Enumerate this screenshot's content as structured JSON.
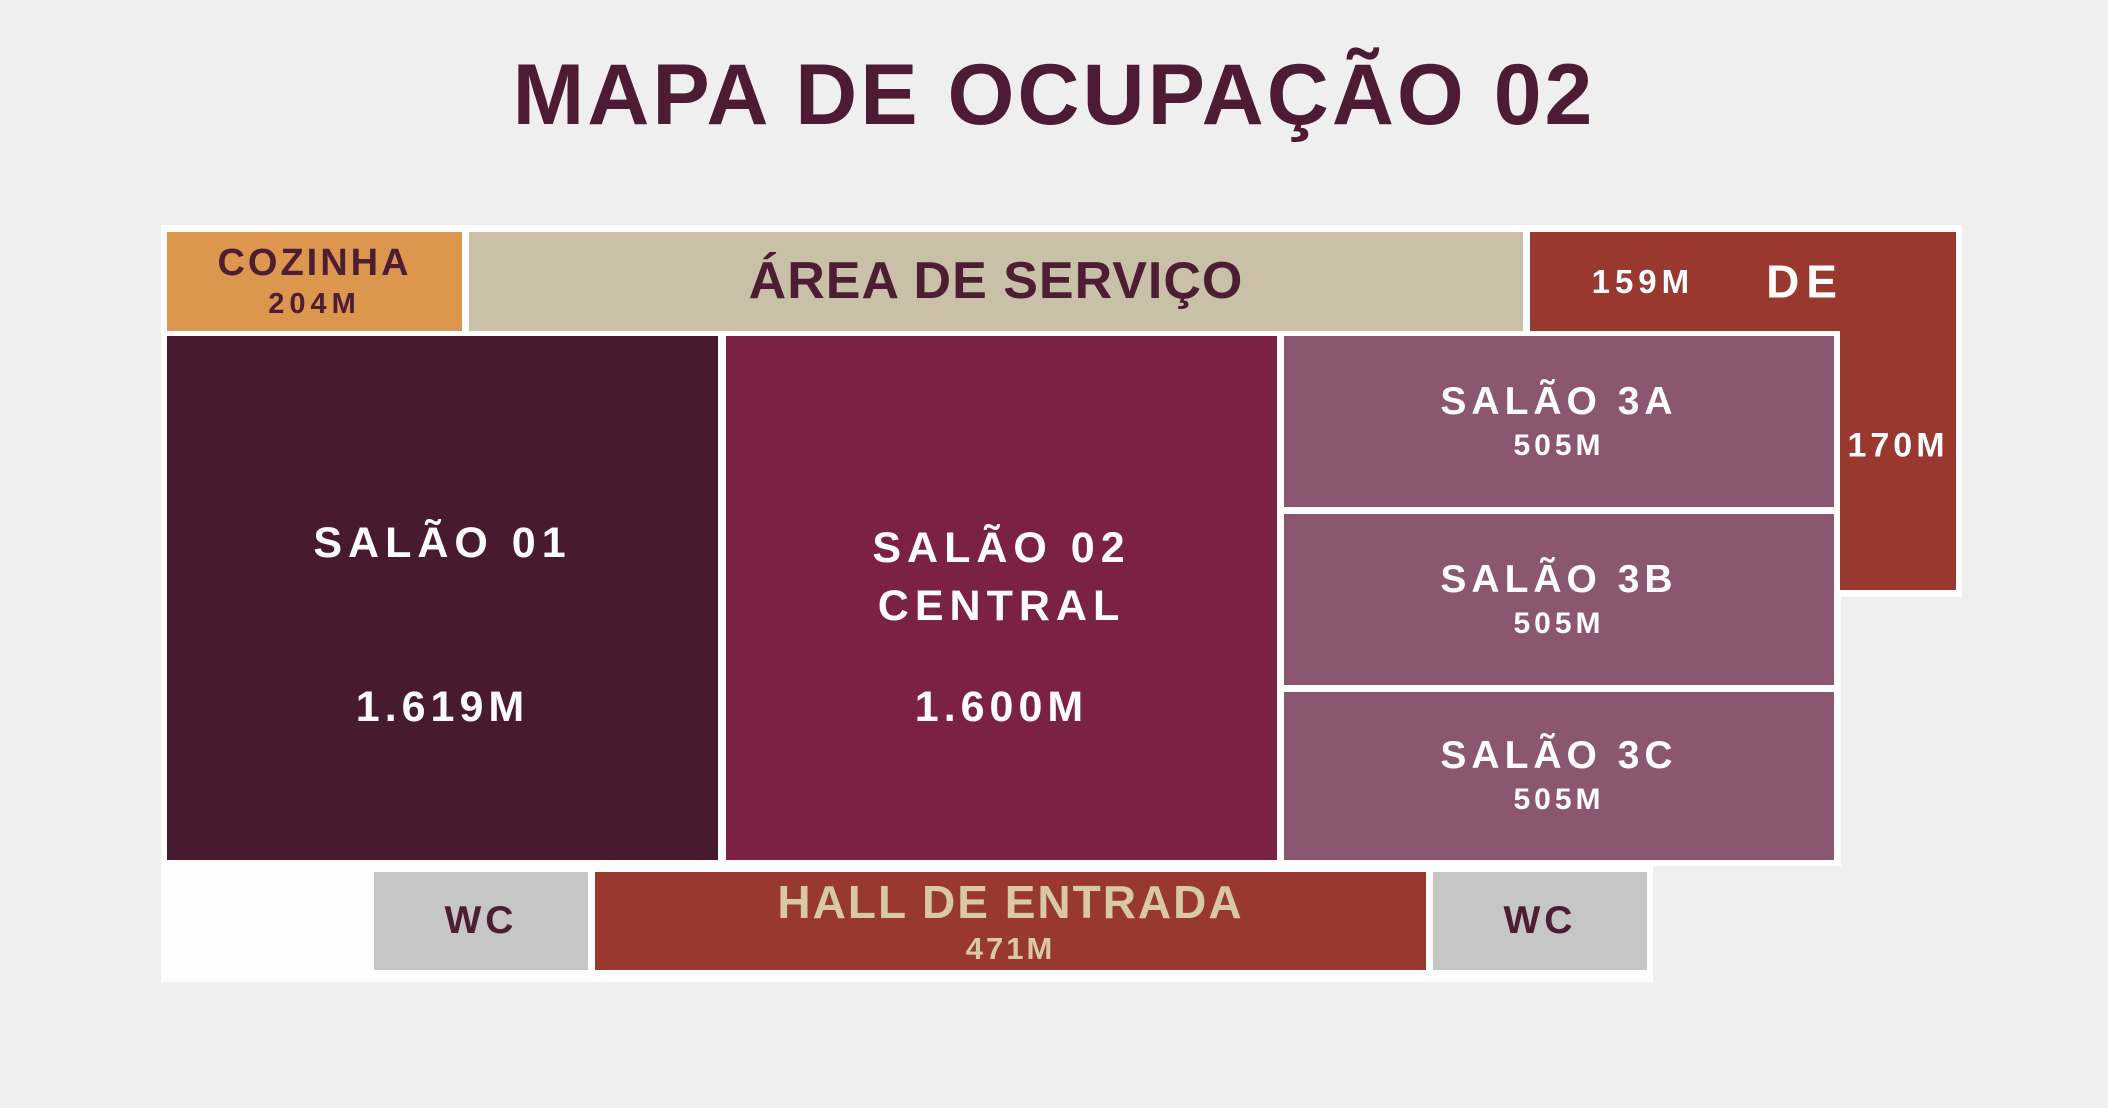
{
  "title": "MAPA DE OCUPAÇÃO 02",
  "palette": {
    "background": "#f0eff0",
    "frame_white": "#fdfdfd",
    "title_text": "#4d1c34",
    "dark_text": "#4d1d34",
    "light_text": "#fdfcfd",
    "hall_text": "#d8c8a6",
    "cozinha_fill": "#dd964d",
    "servico_fill": "#c9c0a8",
    "deck_hall_fill": "#98382f",
    "salao01_fill": "#481a30",
    "salao02_fill": "#7b2143",
    "salao3_fill": "#8a5670",
    "wc_fill": "#c7c6c7"
  },
  "rooms": {
    "cozinha": {
      "name": "COZINHA",
      "area": "204M"
    },
    "servico": {
      "name": "ÁREA DE SERVIÇO"
    },
    "deck": {
      "name": "DECK",
      "area_top": "159M",
      "area_side": "170M"
    },
    "salao01": {
      "name": "SALÃO 01",
      "area": "1.619M"
    },
    "salao02": {
      "name_line1": "SALÃO 02",
      "name_line2": "CENTRAL",
      "area": "1.600M"
    },
    "salao3a": {
      "name": "SALÃO 3A",
      "area": "505M"
    },
    "salao3b": {
      "name": "SALÃO 3B",
      "area": "505M"
    },
    "salao3c": {
      "name": "SALÃO 3C",
      "area": "505M"
    },
    "wc_left": {
      "name": "WC"
    },
    "hall": {
      "name": "HALL DE ENTRADA",
      "area": "471M"
    },
    "wc_right": {
      "name": "WC"
    }
  }
}
